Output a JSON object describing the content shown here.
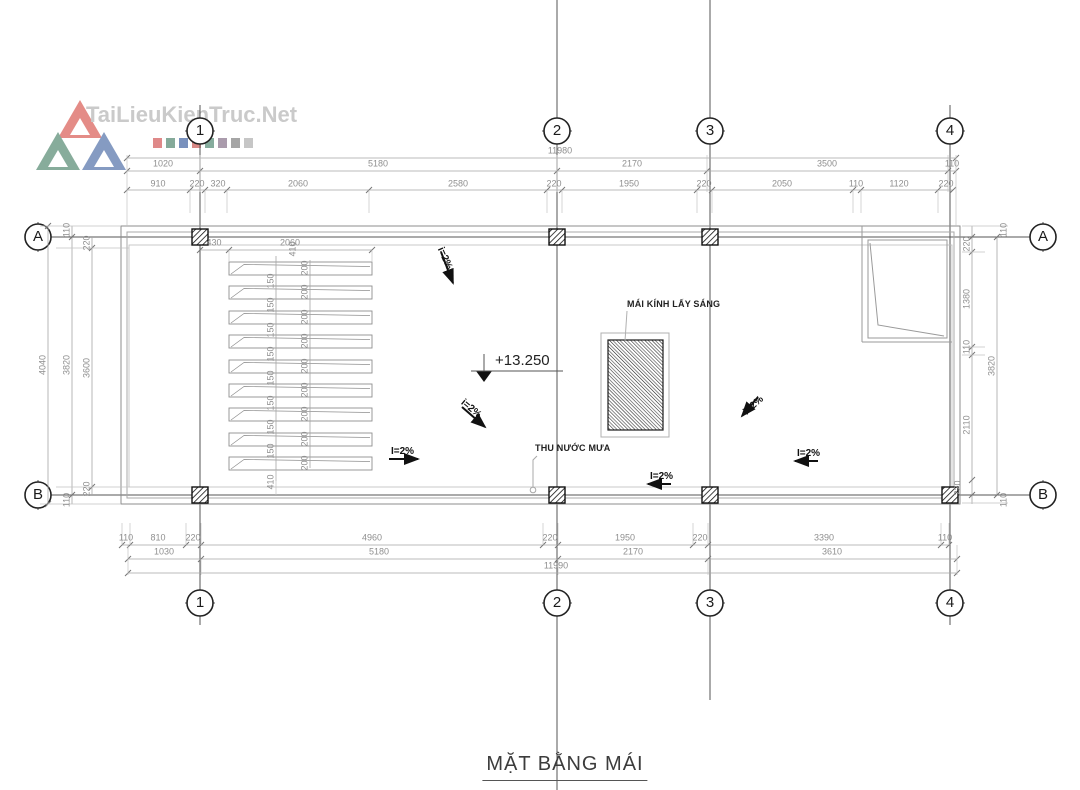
{
  "watermark": {
    "brand": "TaiLieuKienTruc.Net"
  },
  "drawing_title": "MẶT BẰNG MÁI",
  "grid": {
    "cols": [
      "1",
      "2",
      "3",
      "4"
    ],
    "rows": [
      "A",
      "B"
    ]
  },
  "annotations": {
    "skylight": "MÁI KÍNH LẤY SÁNG",
    "rain": "THU NƯỚC MƯA",
    "level": "+13.250",
    "slopes": [
      "i=2%",
      "i=2%",
      "I=2%",
      "i=2%",
      "I=2%",
      "I=2%"
    ]
  },
  "dims": {
    "top": {
      "overall": "11980",
      "major": [
        "1020",
        "5180",
        "2170",
        "3500",
        "110"
      ],
      "minor": [
        "910",
        "220",
        "320",
        "2060",
        "2580",
        "220",
        "1950",
        "220",
        "2050",
        "110",
        "1120",
        "220"
      ]
    },
    "bottom": {
      "overall": "11990",
      "minor": [
        "110",
        "810",
        "220",
        "4960",
        "220",
        "1950",
        "220",
        "3390",
        "110"
      ],
      "major": [
        "1030",
        "5180",
        "2170",
        "3610"
      ]
    },
    "left": {
      "chain": [
        "4040",
        "3820",
        "3600"
      ],
      "small": [
        "110",
        "220",
        "110",
        "220"
      ]
    },
    "right": {
      "chain": [
        "220",
        "1380",
        "110",
        "2110"
      ],
      "overall": "3820",
      "small": [
        "110",
        "220",
        "110"
      ]
    },
    "stairs": {
      "offset": "430",
      "width": "2060",
      "top": "410",
      "bottom": "410",
      "gap": "150",
      "slat": "200"
    }
  }
}
